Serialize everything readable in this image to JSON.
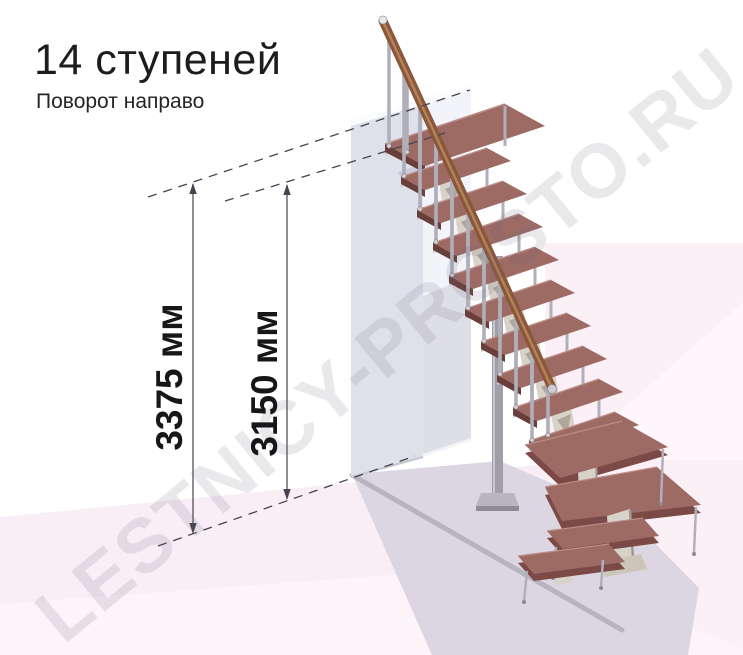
{
  "header": {
    "title": "14 ступеней",
    "subtitle": "Поворот направо"
  },
  "watermark": "LESTNICY-PROSTO.RU",
  "dimension_annotations": [
    {
      "id": "total-height",
      "label": "3375 мм",
      "value_mm": 3375
    },
    {
      "id": "last-step-height",
      "label": "3150 мм",
      "value_mm": 3150
    }
  ],
  "staircase": {
    "total_steps": 14,
    "turn_direction": "направо",
    "colors": {
      "tread": "#9d6a64",
      "tread_front": "#7b4a46",
      "tread_side": "#6a3e3a",
      "tread_nose": "#bb8d85",
      "metal_edge": "#c9c8d0",
      "baluster": "#b1b0ba",
      "handrail": "#8a573b",
      "handrail_highlight": "#b98a5f",
      "wall_left": "#dfe1ea",
      "wall_front": "#f3f4f9",
      "bracket": "#d8d2c8",
      "bracket_shadow": "#a0988e",
      "background_panel": "#fcf0f7",
      "floor": "#f9eef5",
      "cast_shadow": "#dcd6e2",
      "annotation": "#46434e"
    }
  }
}
